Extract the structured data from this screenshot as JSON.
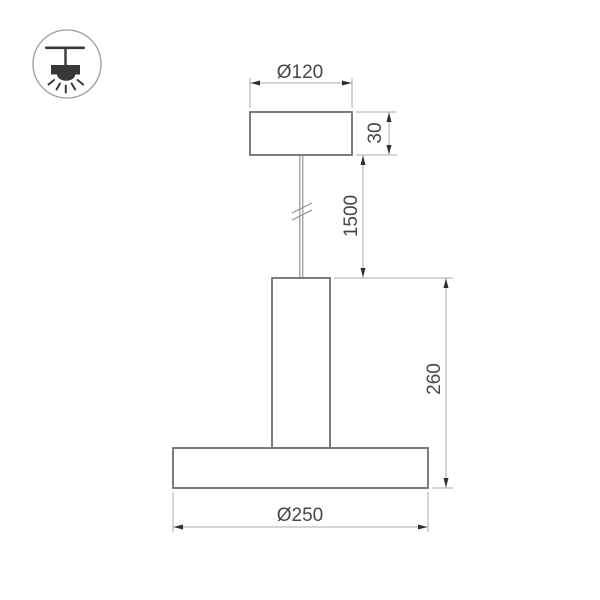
{
  "page": {
    "background": "#ffffff",
    "description": "Technical dimension drawing of a pendant lamp"
  },
  "icon": {
    "name": "pendant-lamp-mounting-icon"
  },
  "labels": {
    "canopy_diameter": "Ø120",
    "canopy_height": "30",
    "suspension_length": "1500",
    "fixture_height": "260",
    "base_diameter": "Ø250"
  },
  "colors": {
    "shape_outline": "#6f6f6f",
    "cable_line": "#8d8d8d",
    "dimension_line": "#ababab",
    "arrow": "#2e2e2e",
    "dimension_text": "#474747",
    "icon_glyph": "#383838",
    "icon_ring": "#9b9b9b",
    "background": "#ffffff"
  }
}
